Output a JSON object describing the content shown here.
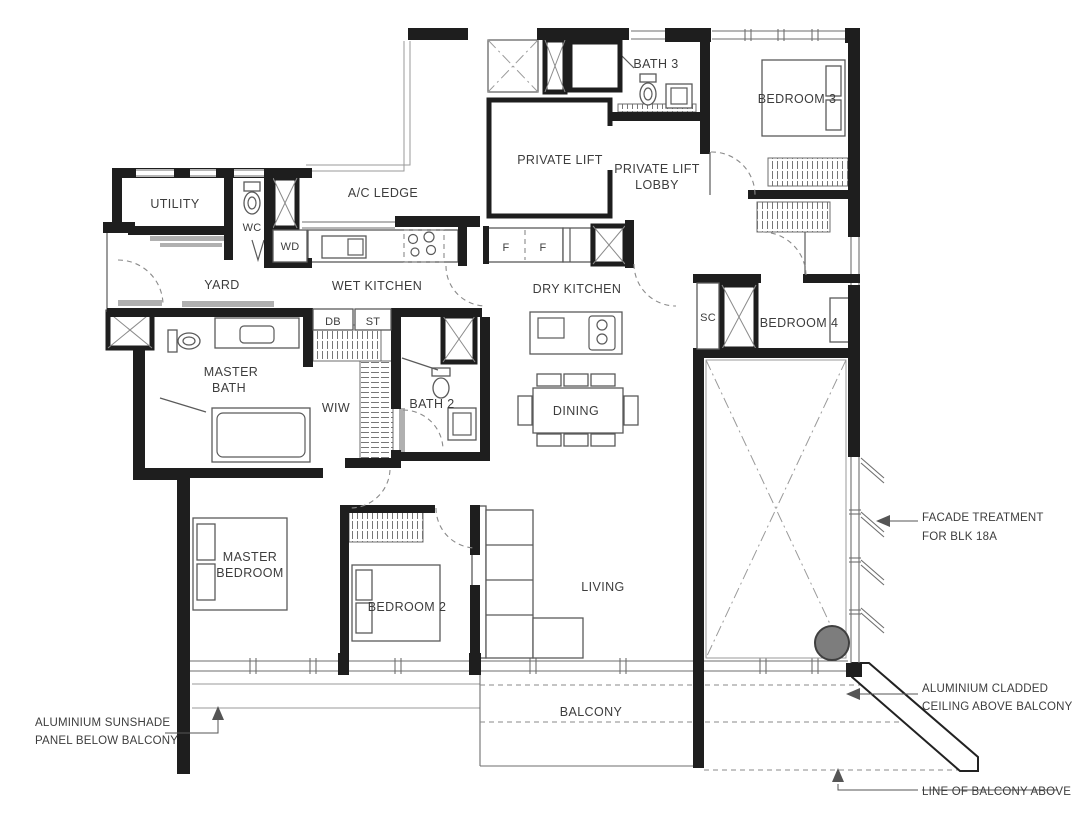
{
  "plan": {
    "rooms": {
      "utility": "UTILITY",
      "wc": "WC",
      "wd": "WD",
      "yard": "YARD",
      "ac_ledge": "A/C LEDGE",
      "wet_kitchen": "WET KITCHEN",
      "dry_kitchen": "DRY KITCHEN",
      "private_lift": "PRIVATE LIFT",
      "lobby_line1": "PRIVATE LIFT",
      "lobby_line2": "LOBBY",
      "bath3": "BATH 3",
      "bedroom3": "BEDROOM 3",
      "sc": "SC",
      "bedroom4": "BEDROOM 4",
      "db": "DB",
      "st": "ST",
      "fridge1": "F",
      "fridge2": "F",
      "master_bath_line1": "MASTER",
      "master_bath_line2": "BATH",
      "wiw": "WIW",
      "bath2": "BATH 2",
      "dining": "DINING",
      "master_bedroom_line1": "MASTER",
      "master_bedroom_line2": "BEDROOM",
      "bedroom2": "BEDROOM 2",
      "living": "LIVING",
      "balcony": "BALCONY"
    },
    "annotations": {
      "facade_line1": "FACADE TREATMENT",
      "facade_line2": "FOR BLK 18A",
      "cladded_line1": "ALUMINIUM CLADDED",
      "cladded_line2": "CEILING ABOVE BALCONY",
      "sunshade_line1": "ALUMINIUM SUNSHADE",
      "sunshade_line2": "PANEL BELOW BALCONY",
      "balcony_above": "LINE OF BALCONY ABOVE"
    },
    "colors": {
      "wall": "#1e1e1e",
      "fixture": "#5a5a5a",
      "light": "#9a9a9a",
      "text": "#3d3d3d",
      "marker": "#7d7d7d"
    }
  }
}
